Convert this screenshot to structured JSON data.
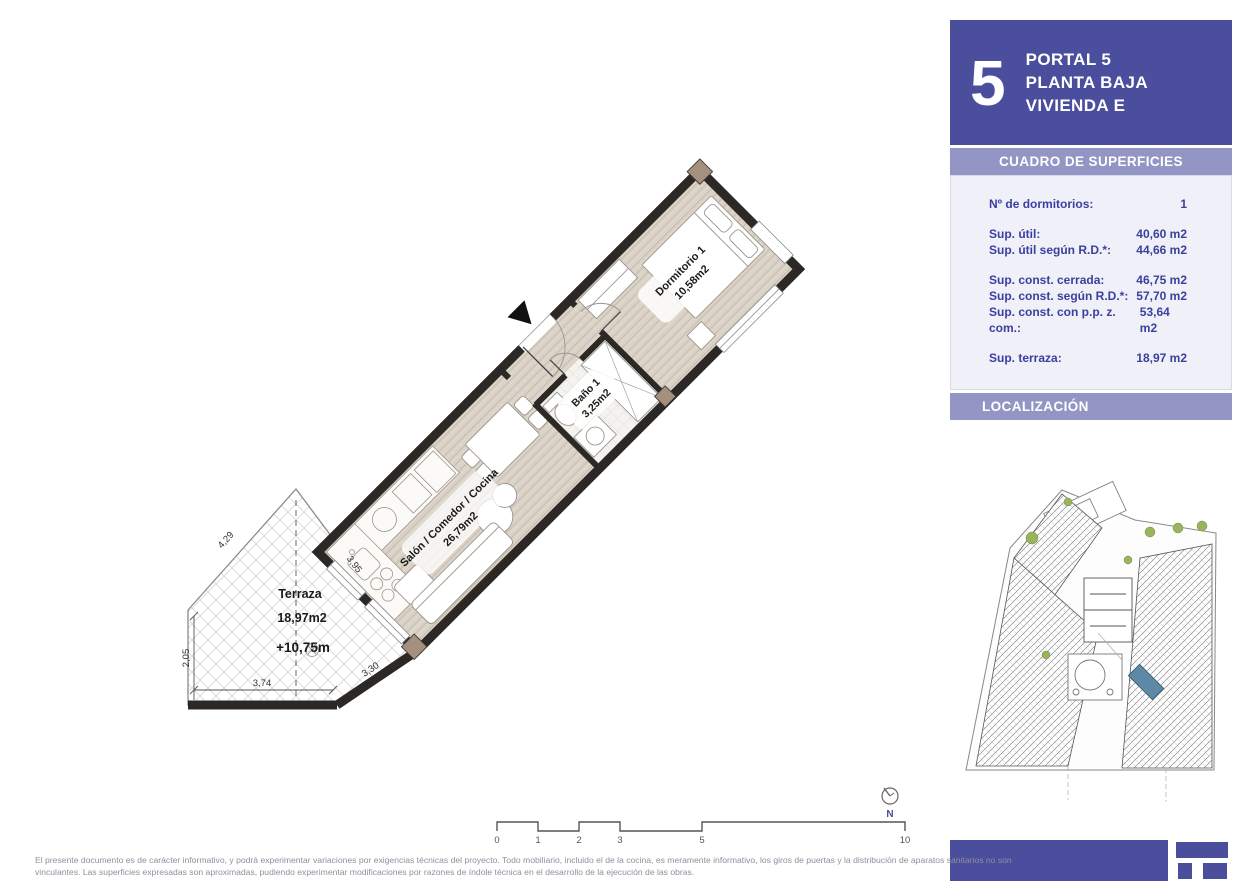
{
  "header": {
    "big_number": "5",
    "lines": [
      "PORTAL 5",
      "PLANTA BAJA",
      "VIVIENDA E"
    ]
  },
  "surfaces": {
    "title": "CUADRO DE SUPERFICIES",
    "rows": [
      {
        "label": "Nº de dormitorios:",
        "value": "1"
      },
      {
        "label": "Sup. útil:",
        "value": "40,60 m2"
      },
      {
        "label": "Sup. útil según R.D.*:",
        "value": "44,66 m2"
      },
      {
        "label": "Sup. const. cerrada:",
        "value": "46,75 m2"
      },
      {
        "label": "Sup. const. según R.D.*:",
        "value": "57,70 m2"
      },
      {
        "label": "Sup. const. con p.p. z. com.:",
        "value": "53,64 m2"
      },
      {
        "label": "Sup. terraza:",
        "value": "18,97 m2"
      }
    ]
  },
  "localizacion": {
    "title": "LOCALIZACIÓN"
  },
  "plan": {
    "rooms": {
      "salon": {
        "name": "Salón / Comedor / Cocina",
        "area": "26,79m2"
      },
      "bano": {
        "name": "Baño 1",
        "area": "3,25m2"
      },
      "dormitorio": {
        "name": "Dormitorio 1",
        "area": "10,58m2"
      },
      "terraza": {
        "name": "Terraza",
        "area": "18,97m2",
        "level": "+10,75m"
      }
    },
    "dimensions": {
      "edge_upper_left": "4,29",
      "edge_upper_right": "3,95",
      "edge_lower_right": "3,30",
      "edge_left": "2,05",
      "edge_bottom": "3,74"
    },
    "north": {
      "label": "N"
    },
    "scale": {
      "ticks": [
        "0",
        "1",
        "2",
        "3",
        "5",
        "10"
      ]
    }
  },
  "footer": {
    "line1": "El presente documento es de carácter informativo, y podrá experimentar variaciones por exigencias técnicas del proyecto. Todo mobiliario, incluido el de la cocina, es meramente informativo, los giros de puertas y la distribución de aparatos sanitarios no son",
    "line2": "vinculantes. Las superficies expresadas son aproximadas, pudiendo experimentar modificaciones por razones de índole técnica en el desarrollo de la ejecución de las obras."
  },
  "colors": {
    "primary": "#4a4e9c",
    "band": "#9396c5",
    "table_bg": "#eff0f8",
    "table_text": "#3b3f9d",
    "wall": "#2b2826",
    "wood_floor": "#dad2c6",
    "highlight_unit": "#5d89a6"
  }
}
